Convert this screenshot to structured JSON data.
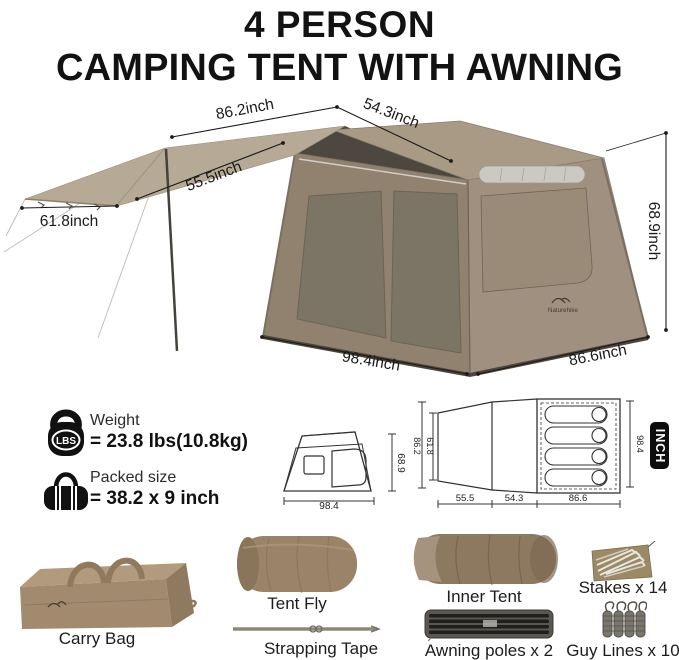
{
  "title": {
    "line1": "4 PERSON",
    "line2": "CAMPING TENT WITH AWNING"
  },
  "brand": "Naturehike",
  "hero_dimensions": {
    "awning_width_top": "86.2inch",
    "roof_ridge": "54.3inch",
    "awning_depth": "55.5inch",
    "awning_front_edge": "61.8inch",
    "tent_height": "68.9inch",
    "tent_front_width": "98.4inch",
    "tent_side_depth": "86.6inch"
  },
  "specs": {
    "weight": {
      "label": "Weight",
      "value": "= 23.8 lbs(10.8kg)",
      "icon": "lbs-weight-icon",
      "icon_text": "LBS"
    },
    "packed": {
      "label": "Packed size",
      "value": "= 38.2 x 9 inch",
      "icon": "duffel-bag-icon"
    }
  },
  "diagrams": {
    "unit_label": "INCH",
    "front_view": {
      "width": "98.4",
      "height": "68.9"
    },
    "floor_plan": {
      "awning_outer_width": "86.2",
      "awning_inner_width": "61.8",
      "awning_depth": "55.5",
      "porch_depth": "54.3",
      "room_depth": "86.6",
      "room_width": "98.4"
    }
  },
  "components": [
    {
      "id": "carry-bag",
      "label": "Carry Bag"
    },
    {
      "id": "tent-fly",
      "label": "Tent Fly"
    },
    {
      "id": "strapping-tape",
      "label": "Strapping Tape"
    },
    {
      "id": "inner-tent",
      "label": "Inner Tent"
    },
    {
      "id": "awning-poles",
      "label": "Awning poles x 2"
    },
    {
      "id": "stakes",
      "label": "Stakes x 14"
    },
    {
      "id": "guy-lines",
      "label": "Guy Lines x 10"
    }
  ],
  "colors": {
    "tent_fabric": "#91826f",
    "tent_roof": "#a89a85",
    "awning_fabric": "#b6a995",
    "dark_underside": "#4d473f",
    "accent_black": "#111111",
    "background": "#ffffff"
  }
}
